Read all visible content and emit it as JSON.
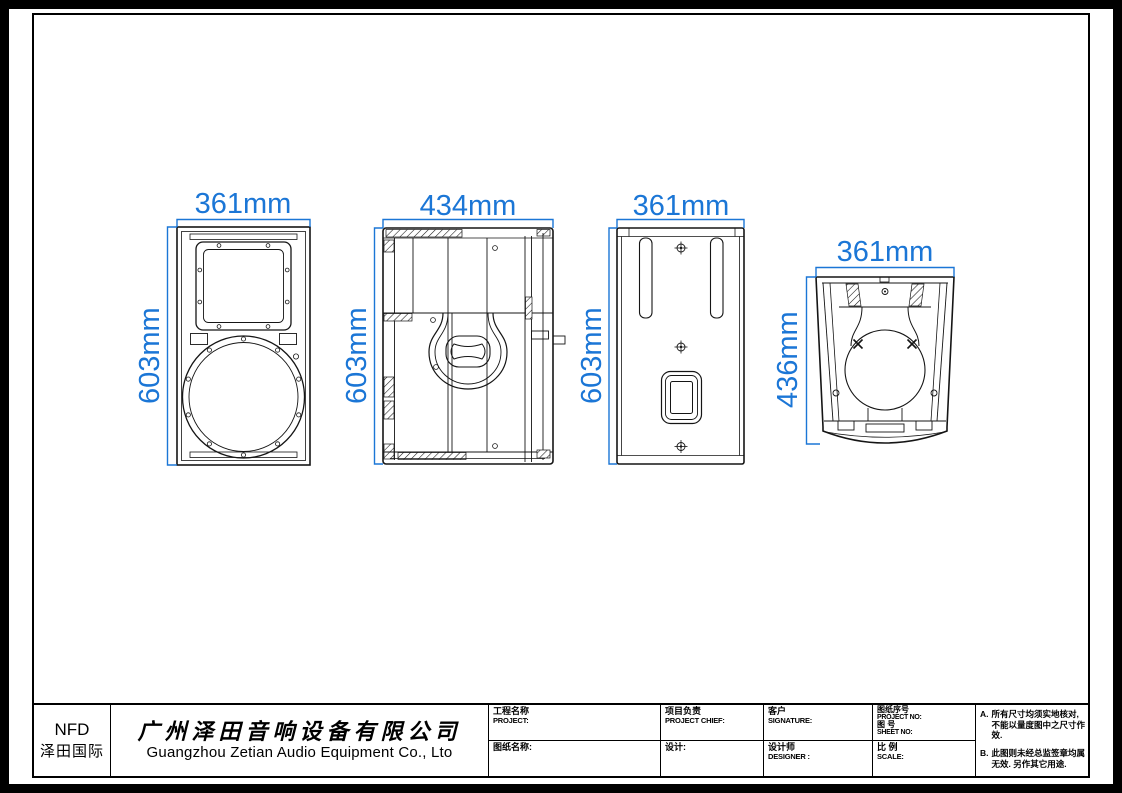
{
  "colors": {
    "dimension_blue": "#1b76d6",
    "line_black": "#151515",
    "background": "#ffffff"
  },
  "drawing": {
    "views": [
      {
        "id": "front",
        "name": "front-view",
        "width_label": "361mm",
        "height_label": "603mm"
      },
      {
        "id": "side",
        "name": "side-view",
        "width_label": "434mm",
        "height_label": "603mm"
      },
      {
        "id": "rear",
        "name": "rear-view",
        "width_label": "361mm",
        "height_label": "603mm"
      },
      {
        "id": "top",
        "name": "top-view",
        "width_label": "361mm",
        "height_label": "436mm"
      }
    ]
  },
  "title_block": {
    "logo_line1": "NFD",
    "logo_line2": "泽田国际",
    "company_cn": "广州泽田音响设备有限公司",
    "company_en": "Guangzhou Zetian Audio Equipment Co., Lto",
    "project_label_cn": "工程名称",
    "project_label_en": "PROJECT:",
    "chief_label_cn": "项目负责",
    "chief_label_en": "PROJECT CHIEF:",
    "client_label_cn": "客户",
    "client_label_en": "SIGNATURE:",
    "projectno_label_cn": "图纸序号",
    "projectno_label_en": "PROJECT NO:",
    "sheetno_label_cn": "图  号",
    "sheetno_label_en": "SHEET  NO:",
    "drawingname_label": "图纸名称:",
    "design_label": "设计:",
    "designer_label_cn": "设计师",
    "designer_label_en": "DESIGNER :",
    "scale_label_cn": "比  例",
    "scale_label_en": "SCALE:",
    "notes": [
      {
        "prefix": "A.",
        "text": "所有尺寸均须实地核对, 不能以量度图中之尺寸作效."
      },
      {
        "prefix": "B.",
        "text": "此图则未经总监签章均属无效. 另作其它用途."
      }
    ]
  }
}
